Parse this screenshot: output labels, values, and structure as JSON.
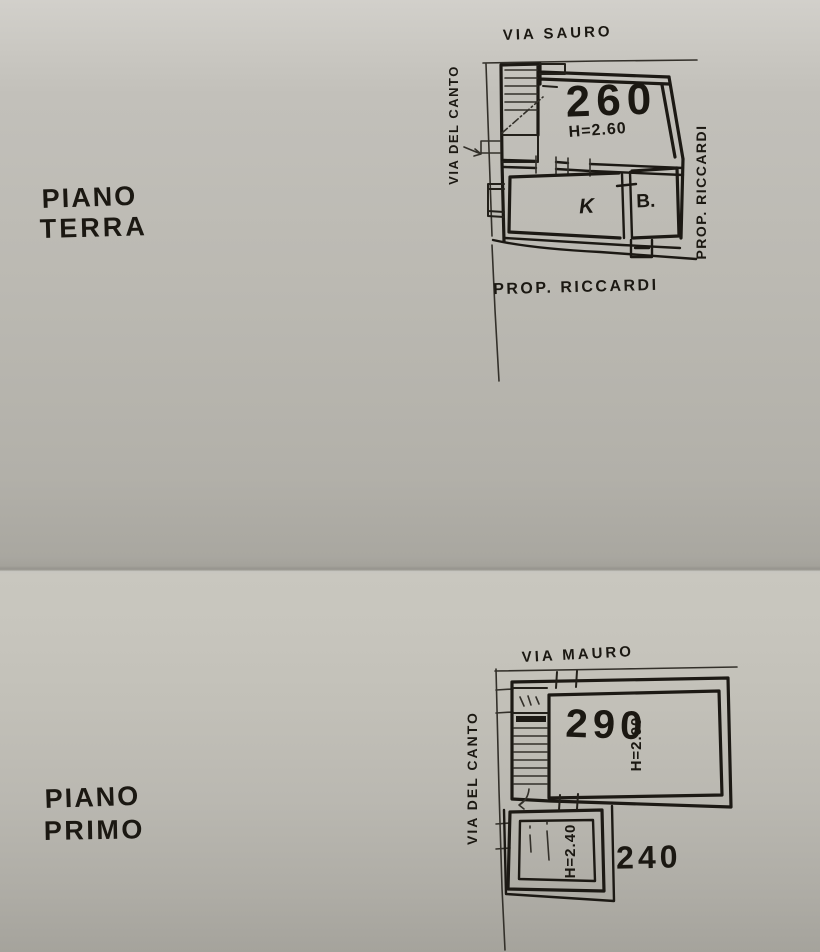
{
  "colors": {
    "paper": "#bcbab3",
    "ink": "#1c1914"
  },
  "floors": [
    {
      "name_line1": "PIANO",
      "name_line2": "TERRA",
      "street_top": "VIA  SAURO",
      "street_side": "VIA  DEL  CANTO",
      "property_right": "PROP. RICCARDI",
      "property_bottom": "PROP.  RICCARDI",
      "room_main_number": "260",
      "room_main_height": "H=2.60",
      "room_kitchen": "K",
      "room_bath": "B."
    },
    {
      "name_line1": "PIANO",
      "name_line2": "PRIMO",
      "street_top": "VIA  MAURO",
      "street_side": "VIA  DEL  CANTO",
      "room_main_number": "290",
      "room_main_height": "H=2.90",
      "room_annex_number": "240",
      "room_annex_height": "H=2.40"
    }
  ]
}
